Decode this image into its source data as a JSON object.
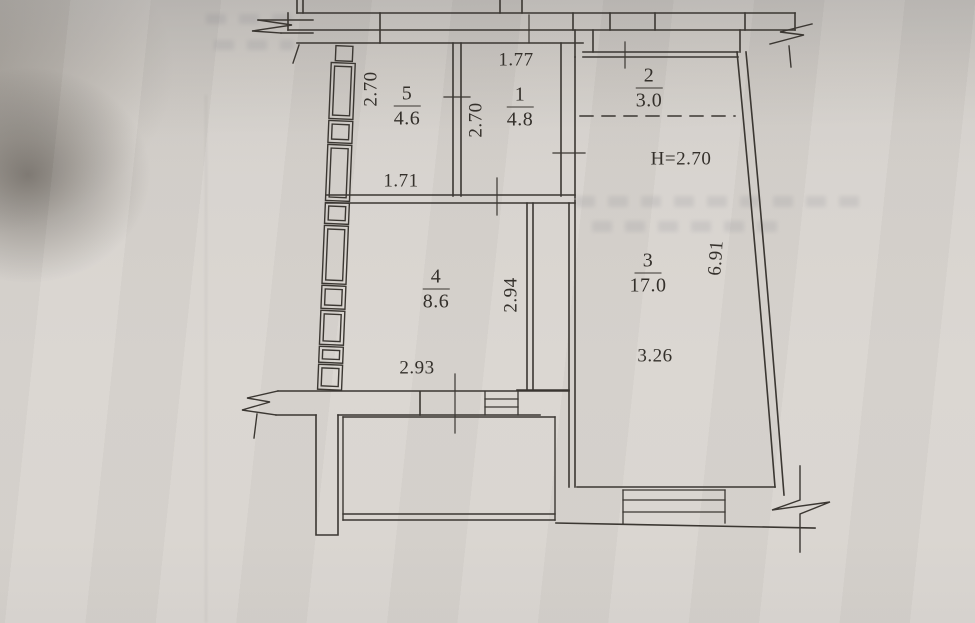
{
  "colors": {
    "paper": "#d7d3ce",
    "ink": "#3b3732"
  },
  "rooms": [
    {
      "number": "5",
      "area": "4.6"
    },
    {
      "number": "1",
      "area": "4.8"
    },
    {
      "number": "2",
      "area": "3.0"
    },
    {
      "number": "3",
      "area": "17.0"
    },
    {
      "number": "4",
      "area": "8.6"
    }
  ],
  "dimensions": {
    "room5_width_vertical": "2.70",
    "room5_bottom": "1.71",
    "room1_top": "1.77",
    "room1_side_vertical": "2.70",
    "hall_ceiling_height": "H=2.70",
    "room3_inner": "3.26",
    "room3_side_vertical": "6.91",
    "room4_side_vertical": "2.94",
    "room4_bottom": "2.93"
  }
}
